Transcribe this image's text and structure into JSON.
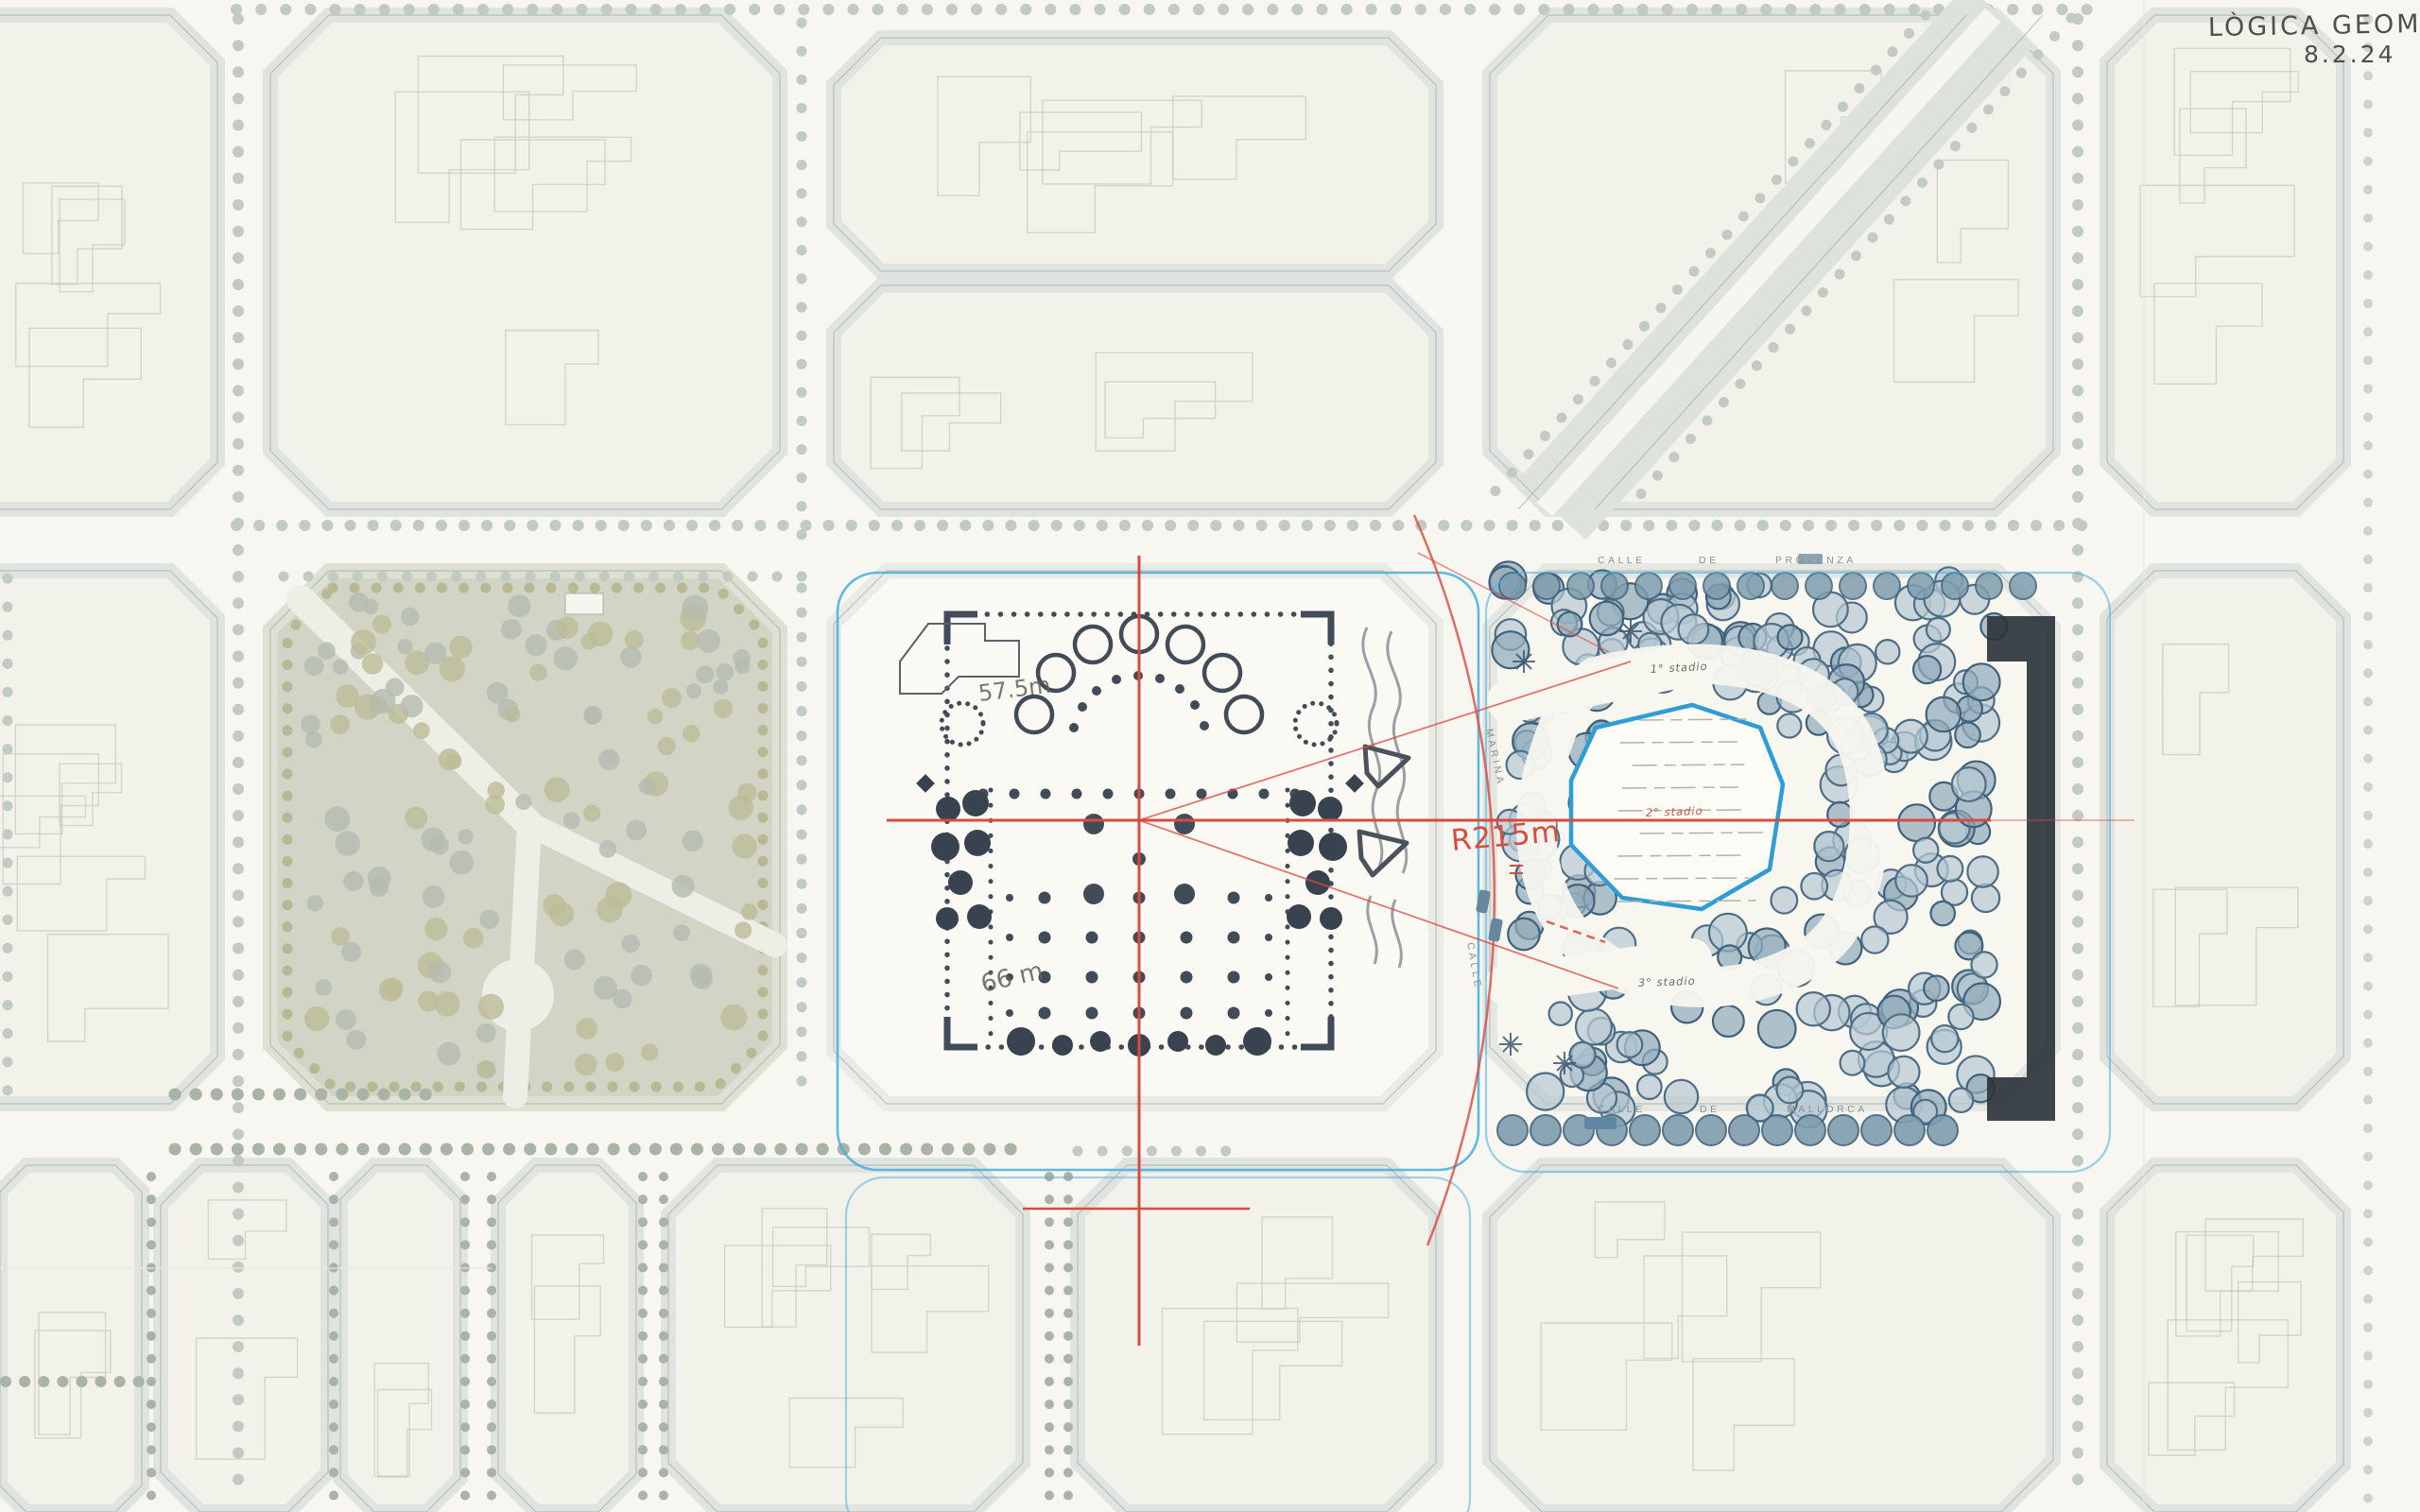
{
  "titleblock": {
    "title": "LÒGICA GEOMETRICA",
    "date": "8.2.24"
  },
  "annotations": {
    "radius": "R215m",
    "apse_width": "57.5m",
    "nave_width": "66 m",
    "stage_1": "1° stadio",
    "stage_2": "2° stadio",
    "stage_3": "3° stadio"
  },
  "streets": {
    "provenza": [
      "CALLE",
      "DE",
      "PROVENZA"
    ],
    "mallorca": [
      "CALLE",
      "DE",
      "MALLORCA"
    ],
    "marina": [
      "MARINA",
      "CALLE"
    ]
  },
  "palette": {
    "paper": "#f8f6f0",
    "sidewalk": "#e0e4e0",
    "block_edge": "#a9aeab",
    "faint_building": "#c9ccc6",
    "park_fill": "#d2d4c5",
    "park_tree": "#bcbb96",
    "cathedral_ink": "#414c58",
    "plaza_tree_stroke": "#4e6e86",
    "plaza_tree_fill": "#b7c9d3",
    "pond_blue": "#2f9cd6",
    "dark_building": "#2d343c",
    "red_geometry": "#d84b3f",
    "cyan_line": "#45aede",
    "graphite": "#5f5e56"
  }
}
